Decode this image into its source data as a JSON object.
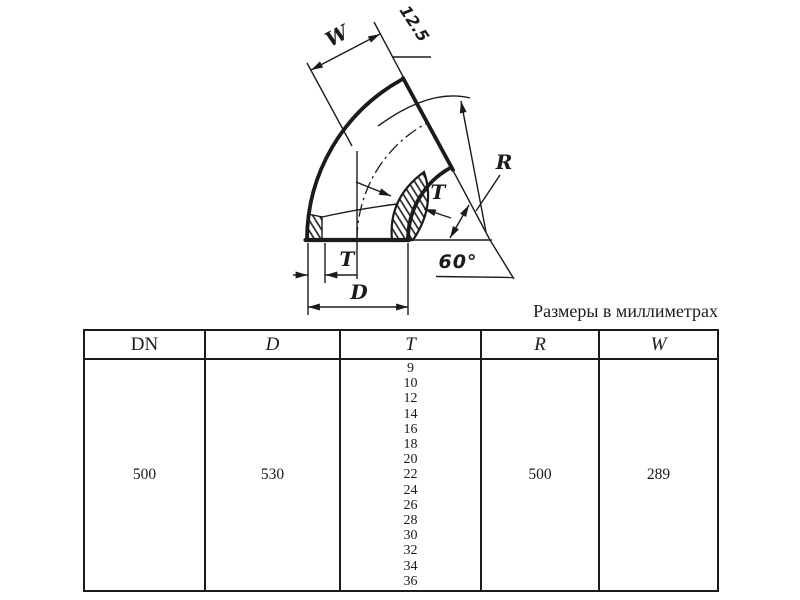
{
  "page": {
    "background": "#ffffff",
    "line_color": "#1b1b1b",
    "note_units": "Размеры в миллиметрах"
  },
  "drawing": {
    "description": "60-degree pipe elbow section drawing",
    "labels": {
      "width": "W",
      "bevel": "12.5",
      "radius": "R",
      "wall_mid": "T",
      "wall_end": "T",
      "outer_diameter": "D",
      "bend_angle": "60°"
    }
  },
  "table": {
    "headers": [
      "DN",
      "D",
      "T",
      "R",
      "W"
    ],
    "row": {
      "dn": "500",
      "d": "530",
      "t_values": [
        "9",
        "10",
        "12",
        "14",
        "16",
        "18",
        "20",
        "22",
        "24",
        "26",
        "28",
        "30",
        "32",
        "34",
        "36"
      ],
      "r": "500",
      "w": "289"
    }
  }
}
